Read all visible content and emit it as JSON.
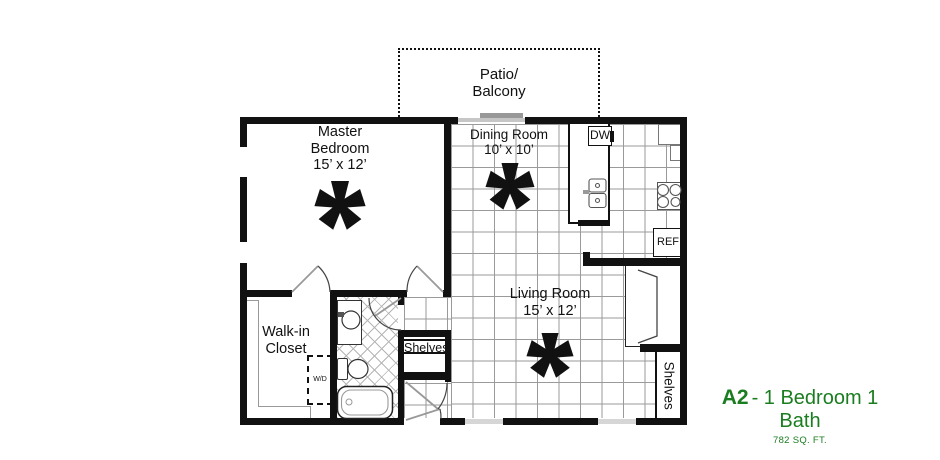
{
  "plan": {
    "code": "A2",
    "name_rest": "- 1 Bedroom 1 Bath",
    "area": "782 SQ. FT.",
    "colors": {
      "accent": "#1a7d1f",
      "walls": "#111111",
      "tile_line": "#9a9a9a"
    },
    "patio": {
      "line1": "Patio/",
      "line2": "Balcony"
    },
    "master": {
      "line1": "Master",
      "line2": "Bedroom",
      "dims": "15’ x 12’"
    },
    "dining": {
      "name": "Dining Room",
      "dims": "10’ x 10’"
    },
    "living": {
      "name": "Living Room",
      "dims": "15’ x 12’"
    },
    "walkin": {
      "line1": "Walk-in",
      "line2": "Closet"
    },
    "shelves_hall": "Shelves",
    "shelves_living": "Shelves",
    "washer_dryer": "W/D",
    "dishwasher": "DW",
    "refrigerator": "REF"
  }
}
